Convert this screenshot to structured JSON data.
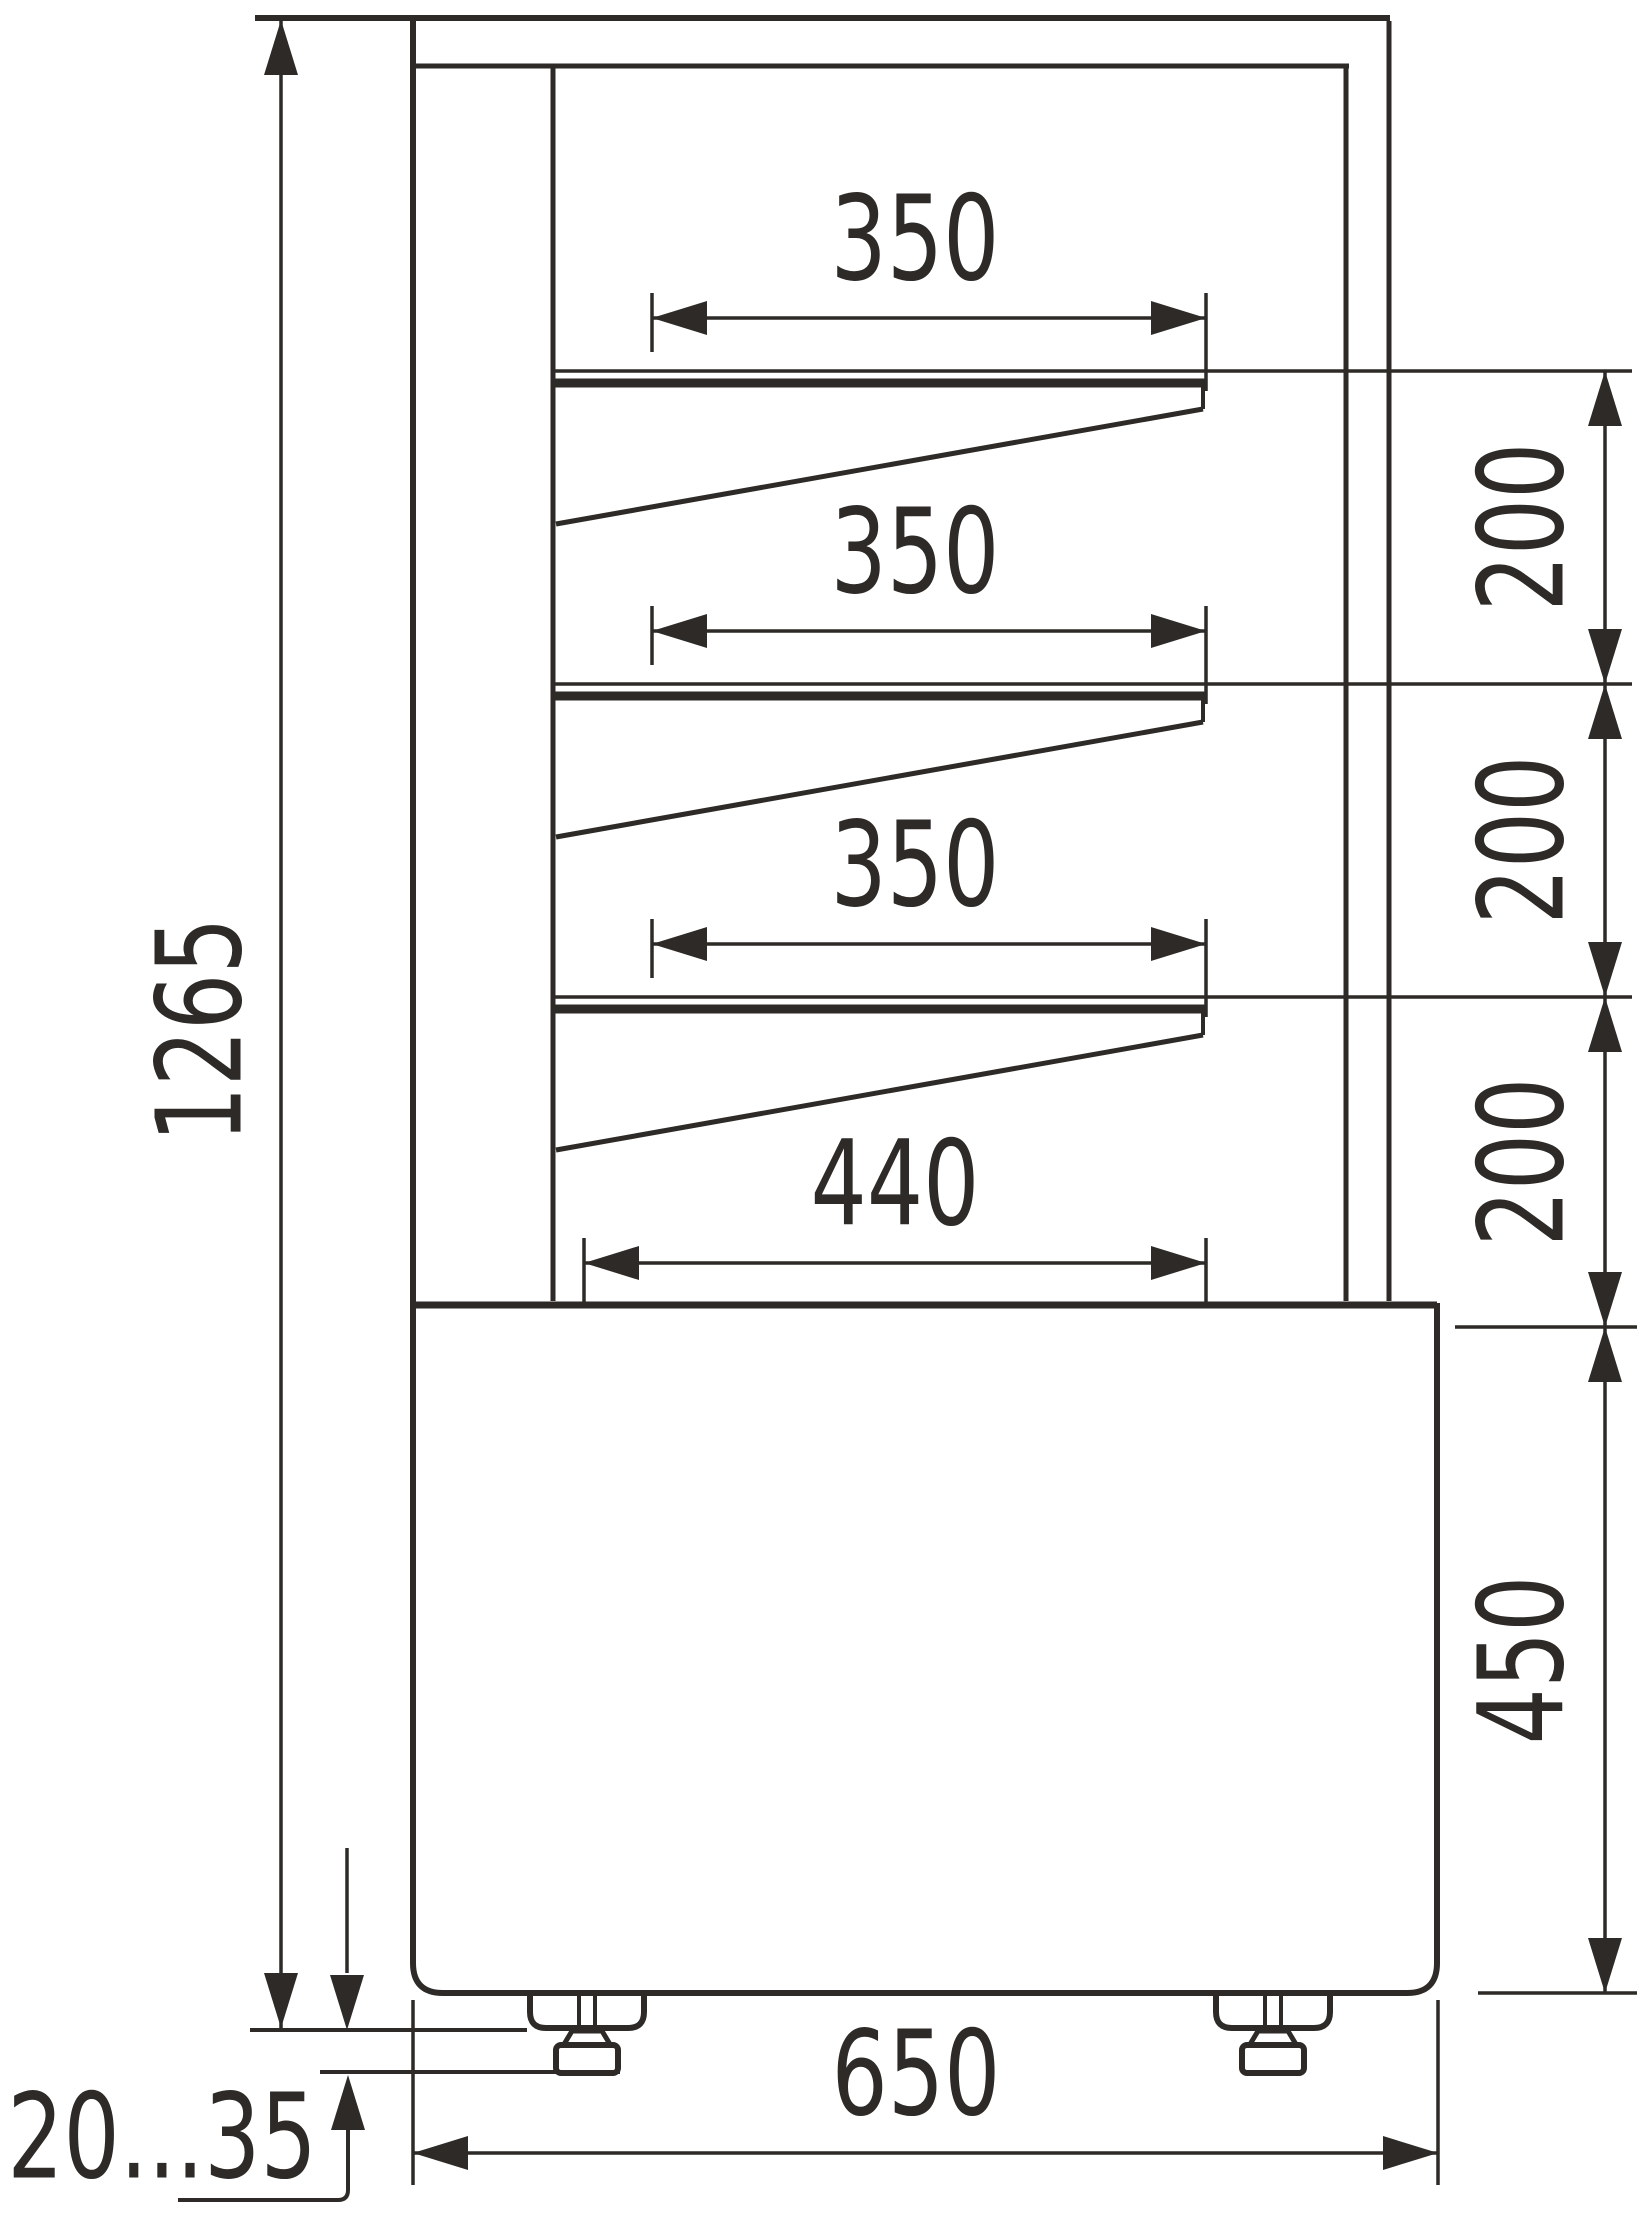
{
  "drawing_type": "refrigerated display case side-view technical drawing",
  "dims": {
    "overall_height": "1265",
    "shelf1_width": "350",
    "shelf2_width": "350",
    "shelf3_width": "350",
    "bottom_shelf_width": "440",
    "gap1": "200",
    "gap2": "200",
    "gap3": "200",
    "base_height": "450",
    "base_width": "650",
    "feet_range": "20...35"
  },
  "colors": {
    "line": "#2d2a27",
    "background": "#ffffff"
  }
}
